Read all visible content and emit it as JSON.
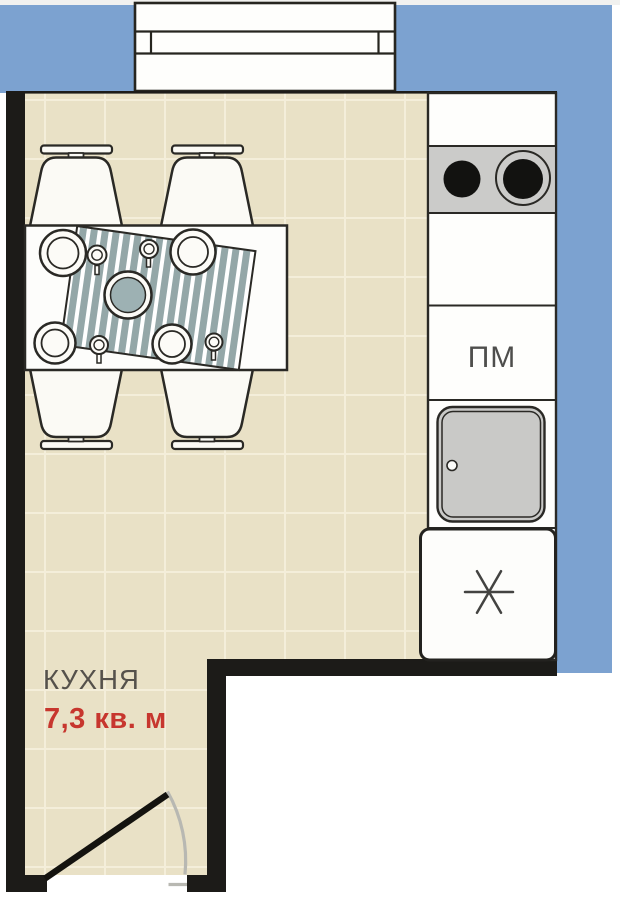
{
  "plan": {
    "room_label": "КУХНЯ",
    "room_area": "7,3 кв. м",
    "appliances": {
      "dishwasher_label": "ПМ",
      "fridge_icon": "snowflake-asterisk",
      "stove_icon": "two-burner-cooktop",
      "sink_icon": "sink-basin-with-drain"
    },
    "furniture": {
      "table": "dining-table-with-striped-runner",
      "chairs_count": 4,
      "dishes": "plates-bowl-cups"
    },
    "openings": {
      "window": "window-top-wall",
      "door": "swing-door-bottom-left"
    },
    "colors": {
      "outside_blue": "#7ca2d0",
      "wall_black": "#1c1b18",
      "floor_beige": "#e9e1c6",
      "floor_grid": "#f4eeda",
      "area_red": "#c7362e",
      "label_gray": "#55514b",
      "appliance_gray": "#c9c9c7",
      "stove_gray": "#cbcbc9",
      "runner_stripe_teal": "#94a7a8",
      "bowl_teal": "#9db1b3"
    }
  }
}
